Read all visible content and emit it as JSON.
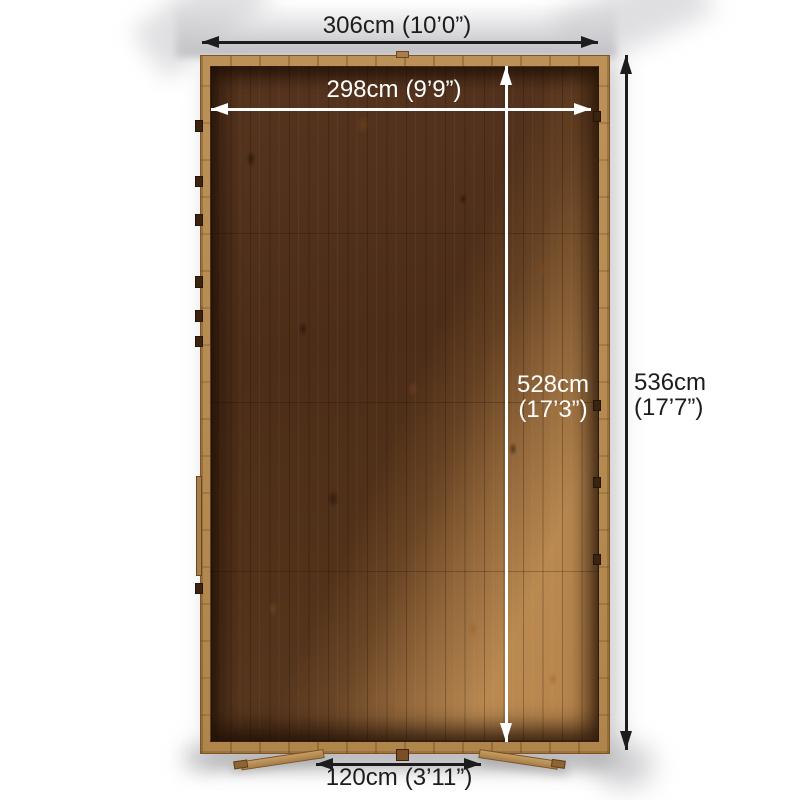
{
  "dimensions": {
    "outer_width": {
      "cm": "306cm",
      "imperial": "(10’0”)"
    },
    "inner_width": {
      "cm": "298cm",
      "imperial": "(9’9”)"
    },
    "inner_depth": {
      "cm": "528cm",
      "imperial": "(17’3”)"
    },
    "outer_depth": {
      "cm": "536cm",
      "imperial": "(17’7”)"
    },
    "door_width": {
      "cm": "120cm",
      "imperial": "(3’11”)"
    }
  },
  "colors": {
    "outer_dimension_lines": "#1c1c1c",
    "inner_dimension_lines": "#ffffff",
    "background": "#ffffff",
    "wood_frame": "#b28a55",
    "wood_interior_dark": "#4f3019",
    "wood_interior_lit": "#b3834d"
  }
}
